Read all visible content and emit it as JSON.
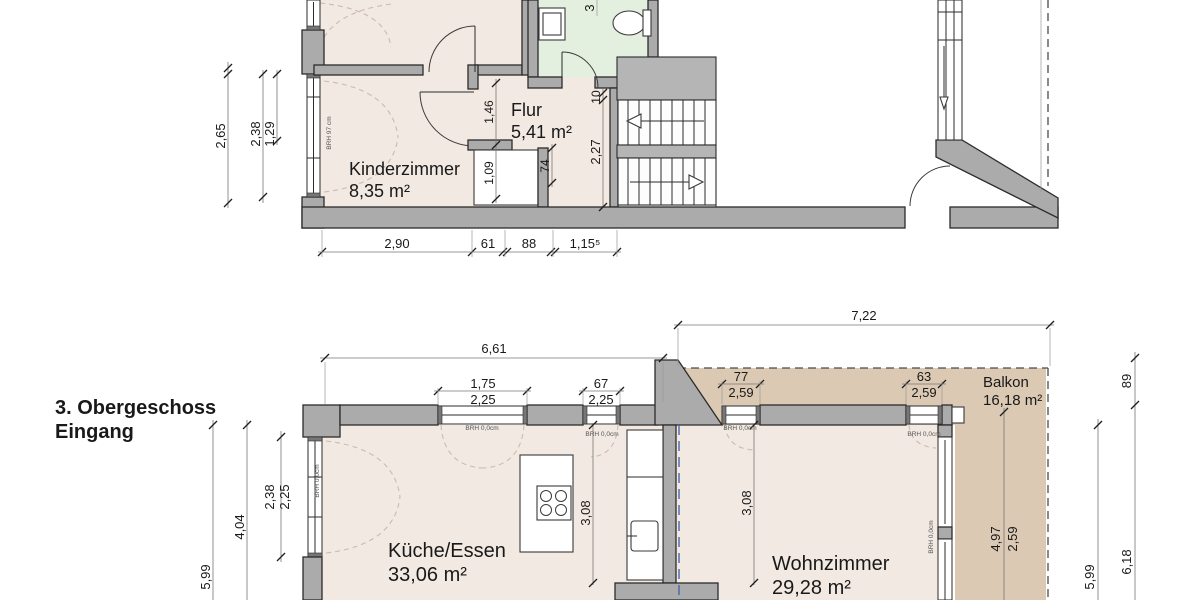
{
  "upper_floor": {
    "rooms": [
      {
        "name": "Kinderzimmer",
        "area": "8,35 m²"
      },
      {
        "name": "Flur",
        "area": "5,41 m²"
      }
    ],
    "window_note": "BRH 97 cm",
    "dims": {
      "left": [
        "2,65",
        "2,38",
        "1,29"
      ],
      "interior": [
        "1,46",
        "1,09",
        "74",
        "10",
        "2,27"
      ],
      "bottom": [
        "2,90",
        "61",
        "88",
        "1,15⁵"
      ],
      "partial_top": "3"
    }
  },
  "lower_floor": {
    "title_lines": [
      "3. Obergeschoss",
      "Eingang"
    ],
    "rooms": [
      {
        "name": "Küche/Essen",
        "area": "33,06 m²"
      },
      {
        "name": "Wohnzimmer",
        "area": "29,28 m²"
      },
      {
        "name": "Balkon",
        "area": "16,18 m²"
      }
    ],
    "window_note": "BRH 0,0cm",
    "dims": {
      "top_overall": [
        "6,61",
        "7,22"
      ],
      "top_windows": [
        [
          "1,75",
          "2,25"
        ],
        [
          "67",
          "2,25"
        ],
        [
          "77",
          "2,59"
        ],
        [
          "63",
          "2,59"
        ]
      ],
      "left": [
        "5,99",
        "4,04",
        "2,38",
        "2,25"
      ],
      "interior": [
        "3,08",
        "3,08"
      ],
      "balcony": [
        "4,97",
        "2,59"
      ],
      "right": [
        "89",
        "6,18",
        "5,99"
      ]
    }
  },
  "colors": {
    "room_fill": "#f2e9e2",
    "bath_fill": "#e3efdf",
    "balcony_fill": "#dbc9b4",
    "wall_fill": "#ababab",
    "section_line": "#4468a8"
  }
}
